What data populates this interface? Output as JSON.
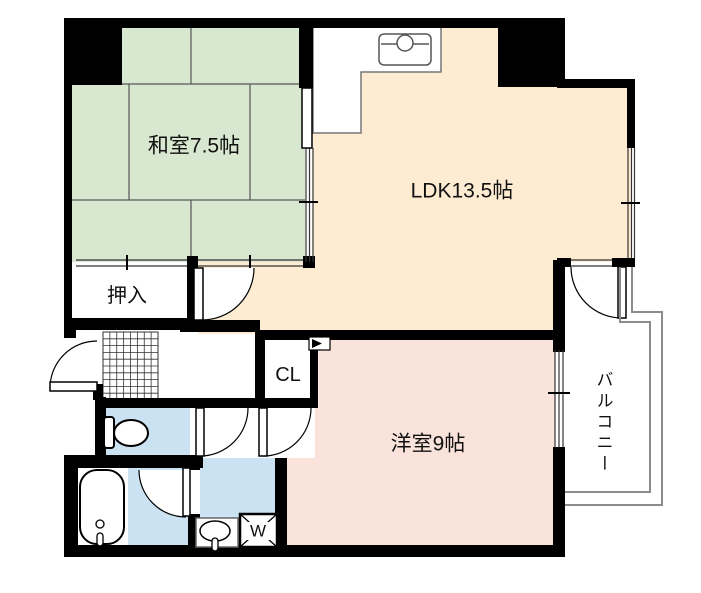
{
  "floorplan": {
    "rooms": {
      "japanese_room": {
        "label": "和室7.5帖"
      },
      "ldk": {
        "label": "LDK13.5帖"
      },
      "western_room": {
        "label": "洋室9帖"
      },
      "oshiire": {
        "label": "押入"
      },
      "closet": {
        "label": "CL"
      },
      "balcony": {
        "label": "バルコニー"
      },
      "washing_machine": {
        "label": "W"
      }
    },
    "colors": {
      "tatami_green": "#d8e7d0",
      "ldk_cream": "#fdecd2",
      "western_pink": "#f9e3db",
      "wet_area_blue": "#cbe2f3",
      "wall_black": "#000000",
      "balcony_outline_gray": "#8c8c8c"
    }
  }
}
